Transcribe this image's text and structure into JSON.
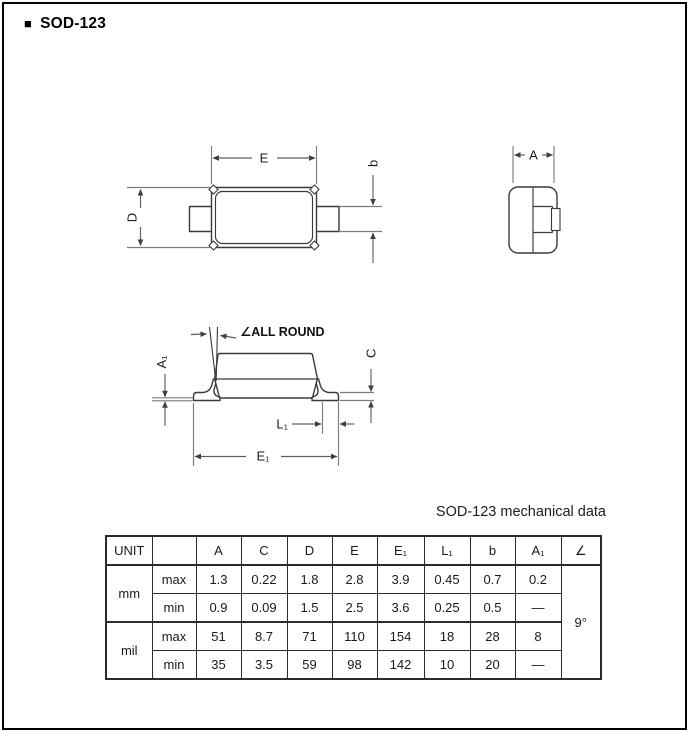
{
  "page": {
    "title_bullet": "■",
    "title": "SOD-123"
  },
  "drawings": {
    "top_view": {
      "dim_E": "E",
      "dim_D": "D",
      "dim_b": "b"
    },
    "end_view": {
      "dim_A": "A"
    },
    "side_view": {
      "callout": "∠ALL ROUND",
      "dim_A1": "A₁",
      "dim_C": "C",
      "dim_L1": "L₁",
      "dim_E1": "E₁"
    }
  },
  "table": {
    "title": "SOD-123 mechanical data",
    "headers": [
      "UNIT",
      "",
      "A",
      "C",
      "D",
      "E",
      "E₁",
      "L₁",
      "b",
      "A₁",
      "∠"
    ],
    "units": {
      "mm": "mm",
      "mil": "mil"
    },
    "rows": [
      {
        "bound": "max",
        "values": [
          "1.3",
          "0.22",
          "1.8",
          "2.8",
          "3.9",
          "0.45",
          "0.7",
          "0.2"
        ]
      },
      {
        "bound": "min",
        "values": [
          "0.9",
          "0.09",
          "1.5",
          "2.5",
          "3.6",
          "0.25",
          "0.5",
          "—"
        ]
      },
      {
        "bound": "max",
        "values": [
          "51",
          "8.7",
          "71",
          "110",
          "154",
          "18",
          "28",
          "8"
        ]
      },
      {
        "bound": "min",
        "values": [
          "35",
          "3.5",
          "59",
          "98",
          "142",
          "10",
          "20",
          "—"
        ]
      }
    ],
    "angle_value": "9°"
  }
}
